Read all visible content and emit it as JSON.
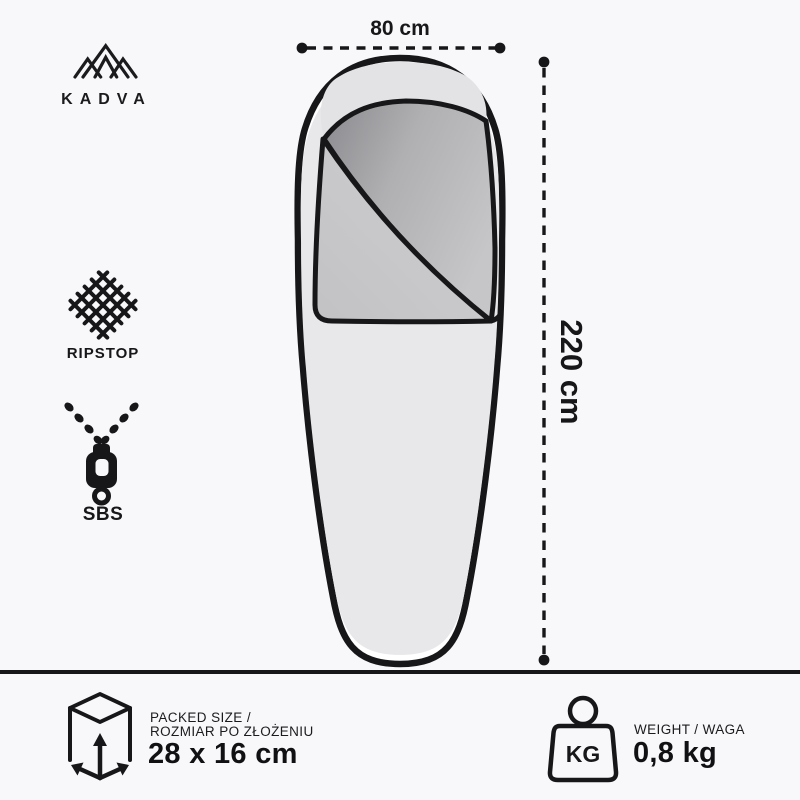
{
  "brand": {
    "name": "KADVA"
  },
  "dimensions": {
    "width": "80 cm",
    "length": "220 cm"
  },
  "features": [
    {
      "id": "ripstop",
      "label": "RIPSTOP",
      "icon": "ripstop-weave-icon"
    },
    {
      "id": "sbs",
      "label": "SBS",
      "icon": "zipper-icon"
    }
  ],
  "packed_size": {
    "label_line1": "PACKED SIZE /",
    "label_line2": "ROZMIAR PO ZŁOŻENIU",
    "value": "28 x 16 cm",
    "icon": "packed-box-icon"
  },
  "weight": {
    "label": "WEIGHT / WAGA",
    "value": "0,8 kg",
    "unit_badge": "KG",
    "icon": "weight-kg-icon"
  },
  "colors": {
    "background": "#f8f8fa",
    "ink": "#17171a",
    "bag_body": "#e8e8ea",
    "bag_dome_shade": "#e3e3e5",
    "lining_dark": "#8a8a8e",
    "lining_light": "#c6c6c8",
    "flap_light": "#d0d0d2",
    "flap_dark": "#c2c2c4"
  }
}
